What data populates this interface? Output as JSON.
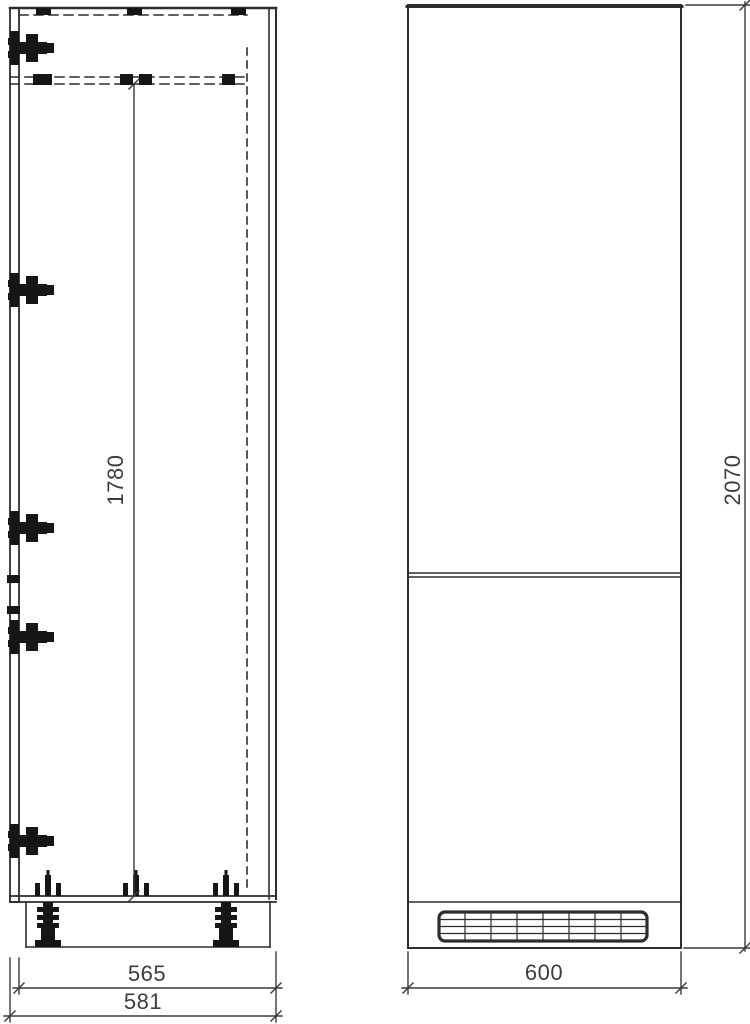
{
  "page": {
    "background_color": "#ffffff",
    "line_color": "#2d2d2d",
    "text_color": "#3d3d3d"
  },
  "drawing": {
    "type": "technical-drawing",
    "views": [
      {
        "id": "side-view",
        "dimensions": [
          {
            "name": "internal-height",
            "value": "1780",
            "orientation": "vertical"
          },
          {
            "name": "carcass-depth",
            "value": "565",
            "orientation": "horizontal"
          },
          {
            "name": "overall-depth",
            "value": "581",
            "orientation": "horizontal"
          }
        ],
        "hinge_count": 5,
        "visible_feet_count": 2
      },
      {
        "id": "front-view",
        "dimensions": [
          {
            "name": "overall-height",
            "value": "2070",
            "orientation": "vertical"
          },
          {
            "name": "overall-width",
            "value": "600",
            "orientation": "horizontal"
          }
        ],
        "grille_columns": 8,
        "grille_rows": 4
      }
    ]
  },
  "labels": {
    "d1780": "1780",
    "d2070": "2070",
    "d565": "565",
    "d581": "581",
    "d600": "600"
  },
  "icons": {
    "hinge": "hinge-icon",
    "foot": "leveling-foot-icon",
    "screws": "foot-fixing-screws-icon",
    "grille": "ventilation-grille-icon"
  }
}
